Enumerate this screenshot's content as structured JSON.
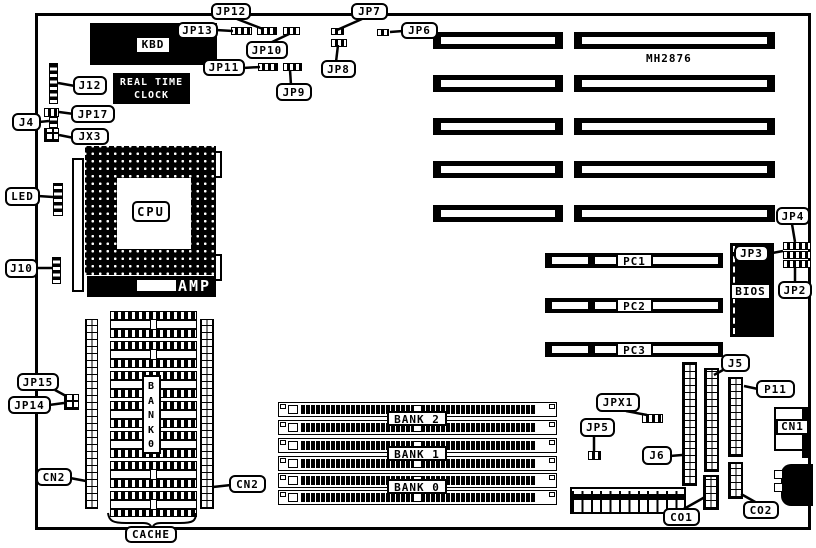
{
  "board": {
    "model": "MH2876",
    "colors": {
      "ink": "#000000",
      "paper": "#ffffff"
    }
  },
  "chips": {
    "kbd": "KBD",
    "rtc_line1": "REAL TIME",
    "rtc_line2": "CLOCK",
    "cpu": "CPU",
    "amp": "AMP",
    "bios": "BIOS",
    "cn1": "CN1"
  },
  "slots": {
    "pc1": "PC1",
    "pc2": "PC2",
    "pc3": "PC3",
    "bank2": "BANK 2",
    "bank1": "BANK 1",
    "bank0": "BANK 0",
    "bank0_vertical": "BANK0"
  },
  "callouts": {
    "jp12": "JP12",
    "jp13": "JP13",
    "jp10": "JP10",
    "jp11": "JP11",
    "jp9": "JP9",
    "jp7": "JP7",
    "jp8": "JP8",
    "jp6": "JP6",
    "j12": "J12",
    "jp17": "JP17",
    "j4": "J4",
    "jx3": "JX3",
    "led": "LED",
    "j10": "J10",
    "jp15": "JP15",
    "jp14": "JP14",
    "cn2_left": "CN2",
    "cn2_right": "CN2",
    "cache": "CACHE",
    "jp4": "JP4",
    "jp3": "JP3",
    "jp2": "JP2",
    "j5": "J5",
    "p11": "P11",
    "jpx1": "JPX1",
    "jp5": "JP5",
    "j6": "J6",
    "co1": "CO1",
    "co2": "CO2"
  }
}
